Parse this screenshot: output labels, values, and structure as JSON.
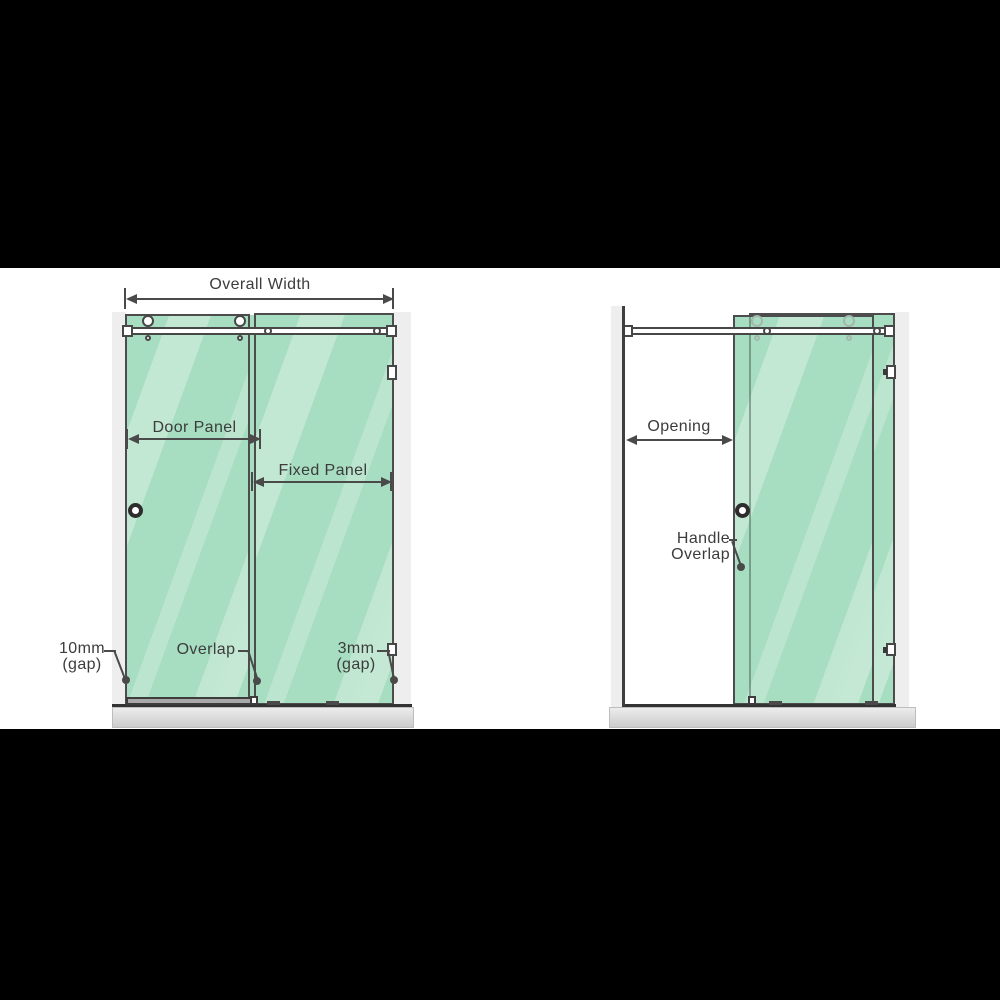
{
  "figure": {
    "type": "shower-screen-sliding-door-dimension-diagram",
    "left_view": {
      "overall_width_label": "Overall Width",
      "door_panel_label": "Door Panel",
      "fixed_panel_label": "Fixed Panel",
      "gap_left_value": "10mm",
      "gap_left_unit": "(gap)",
      "overlap_label": "Overlap",
      "gap_right_value": "3mm",
      "gap_right_unit": "(gap)"
    },
    "right_view": {
      "opening_label": "Opening",
      "handle_overlap_line1": "Handle",
      "handle_overlap_line2": "Overlap"
    },
    "colors": {
      "glass_green": "#a7ddc0",
      "glass_highlight": "#cdeeda",
      "outline": "#4a4a4a",
      "label_text": "#3c3c3c",
      "wall_grey": "#eeeeee",
      "tray_grey": "#d6d6d6",
      "letterbox": "#000000",
      "background": "#ffffff"
    }
  }
}
